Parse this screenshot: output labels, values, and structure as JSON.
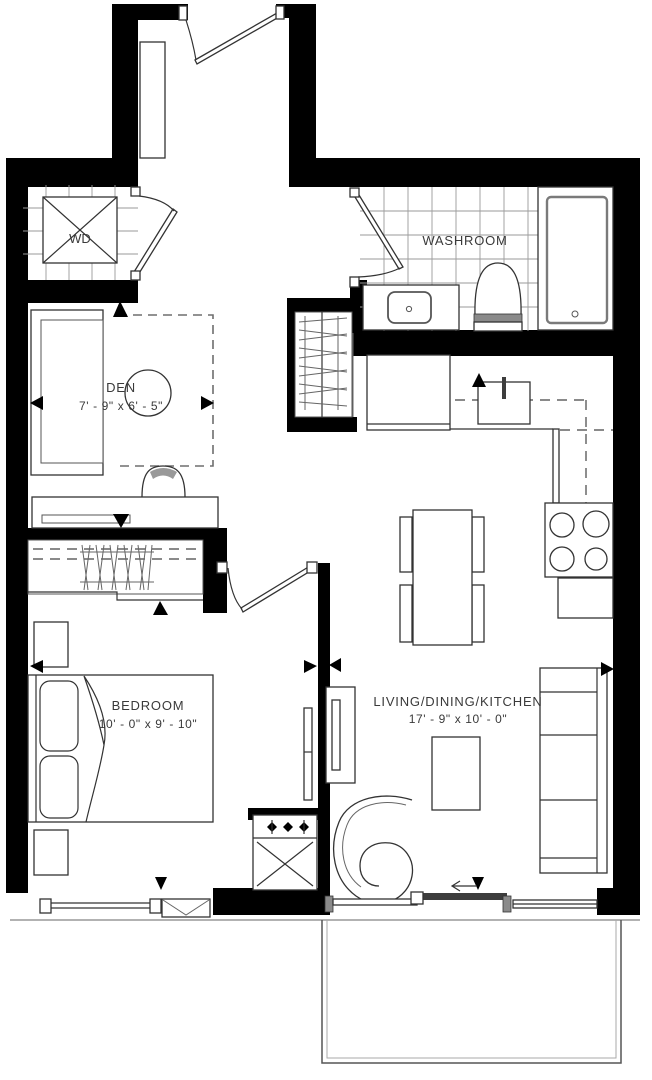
{
  "plan": {
    "title": "1 bedroom + den condo floor plan",
    "rooms": {
      "wd": {
        "label": "WD"
      },
      "washroom": {
        "label": "WASHROOM"
      },
      "den": {
        "label": "DEN",
        "dimensions": "7' - 9\" x 6' - 5\""
      },
      "bedroom": {
        "label": "BEDROOM",
        "dimensions": "10' - 0\" x 9' - 10\""
      },
      "living": {
        "label": "LIVING/DINING/KITCHEN",
        "dimensions": "17' - 9\" x 10' - 0\""
      }
    },
    "colors": {
      "wall": "#000000",
      "line": "#333333",
      "tile_grid": "#9a9a9a",
      "background": "#ffffff"
    }
  }
}
